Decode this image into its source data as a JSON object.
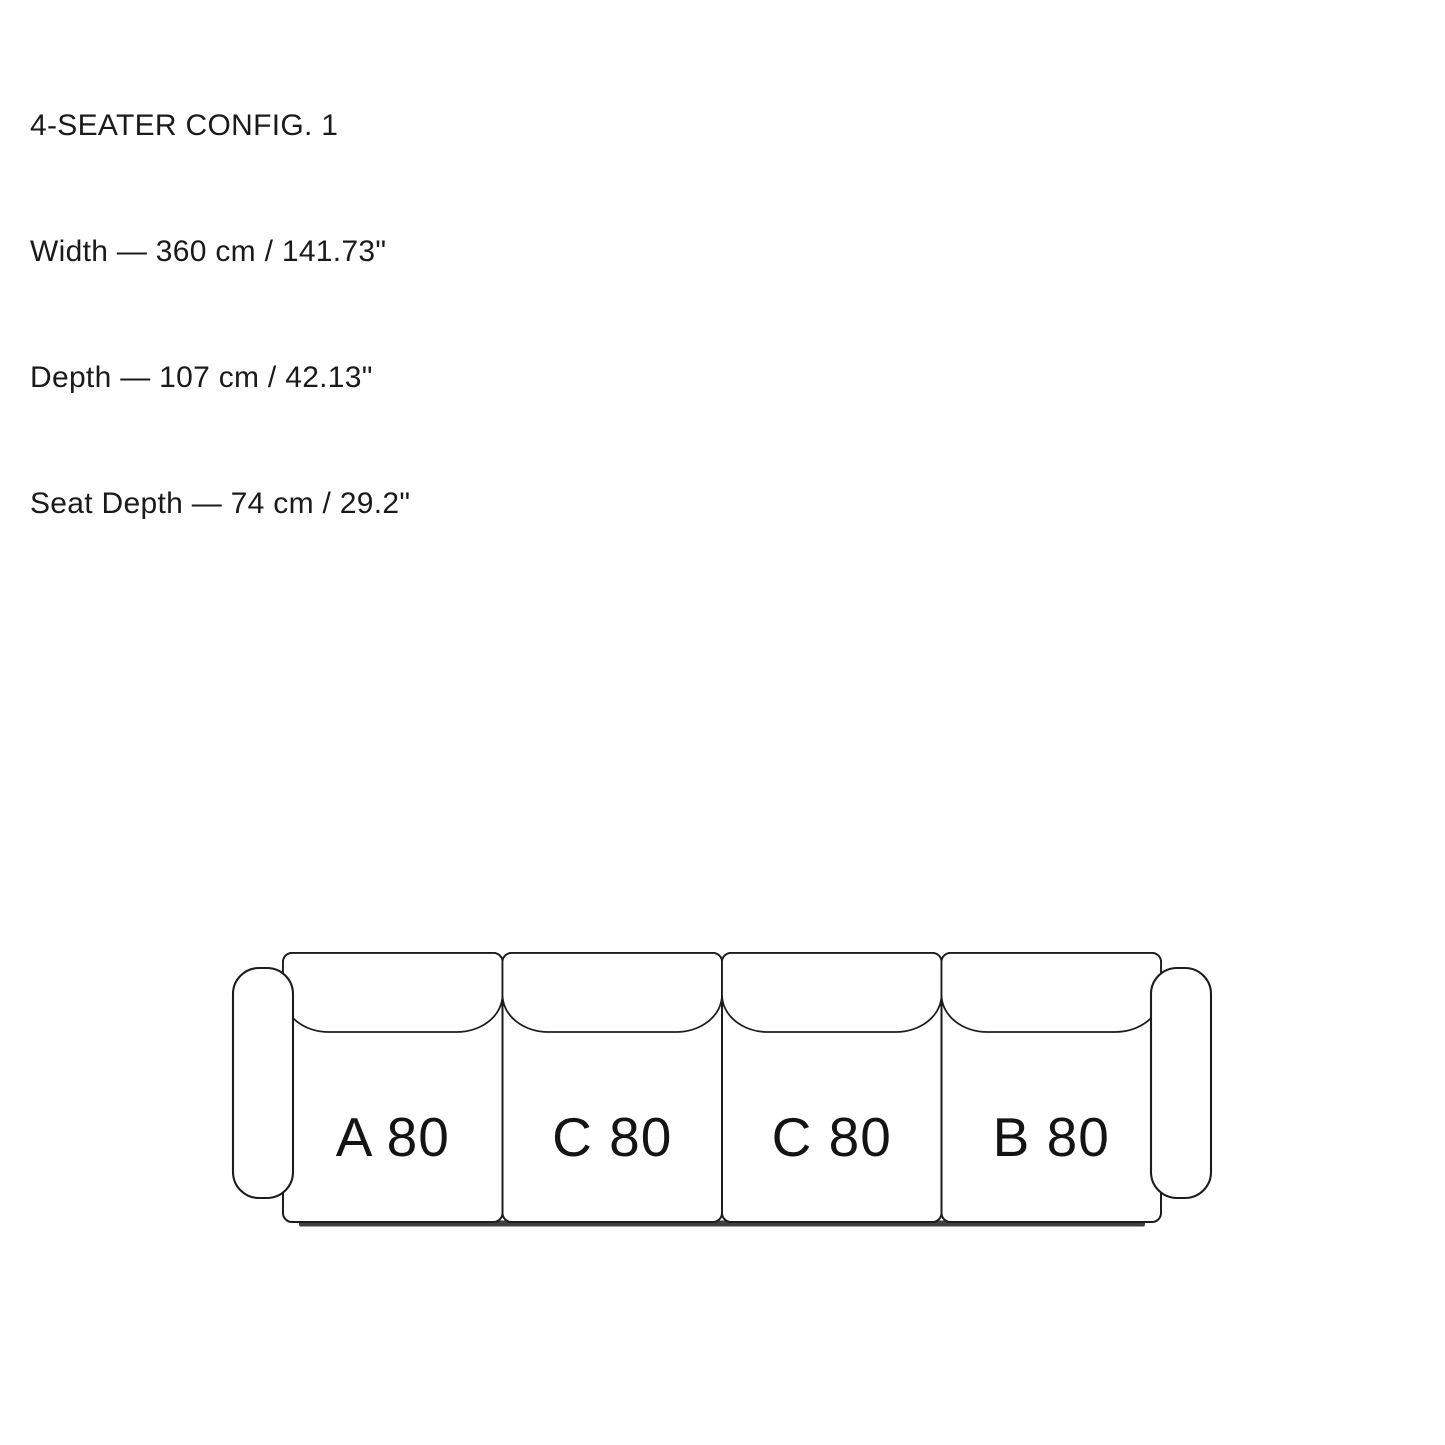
{
  "page": {
    "background_color": "#ffffff",
    "ink_color": "#1c1c1c"
  },
  "info": {
    "title": "4-SEATER CONFIG. 1",
    "width": "Width — 360 cm / 141.73\"",
    "depth": "Depth — 107 cm / 42.13\"",
    "seat_depth": "Seat Depth — 74 cm / 29.2\""
  },
  "sofa": {
    "modules": [
      {
        "label": "A 80"
      },
      {
        "label": "C 80"
      },
      {
        "label": "C 80"
      },
      {
        "label": "B 80"
      }
    ],
    "base_color": "#3f3f3f"
  }
}
